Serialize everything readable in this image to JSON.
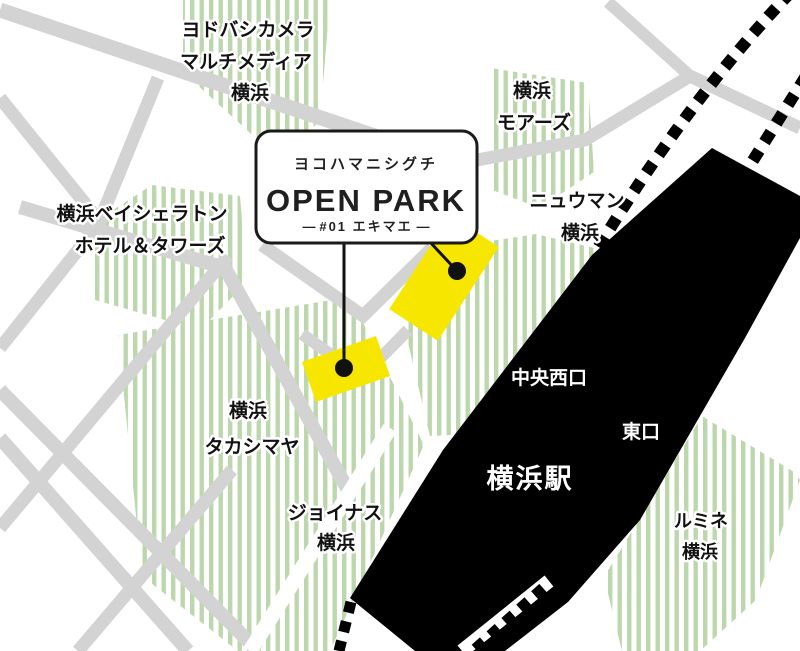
{
  "callout": {
    "kana": "ヨコハマニシグチ",
    "title": "OPEN PARK",
    "subtitle": "#01 エキマエ",
    "dash": "―"
  },
  "places": {
    "yodobashi": {
      "line1": "ヨドバシカメラ",
      "line2": "マルチメディア",
      "line3": "横浜"
    },
    "sheraton": {
      "line1": "横浜ベイシェラトン",
      "line2": "ホテル＆タワーズ"
    },
    "moores": {
      "line1": "横浜",
      "line2": "モアーズ"
    },
    "newoman": {
      "line1": "ニュウマン",
      "line2": "横浜"
    },
    "takashimaya": {
      "line1": "横浜",
      "line2": "タカシマヤ"
    },
    "joinus": {
      "line1": "ジョイナス",
      "line2": "横浜"
    },
    "lumine": {
      "line1": "ルミネ",
      "line2": "横浜"
    }
  },
  "station": {
    "name": "横浜駅",
    "exit_central_west": "中央西口",
    "exit_east": "東口"
  },
  "colors": {
    "block_green": "#bdd7ac",
    "road_gray": "#d3d3d3",
    "highlight_yellow": "#f7e600",
    "station_black": "#000000",
    "line_black": "#111111"
  }
}
